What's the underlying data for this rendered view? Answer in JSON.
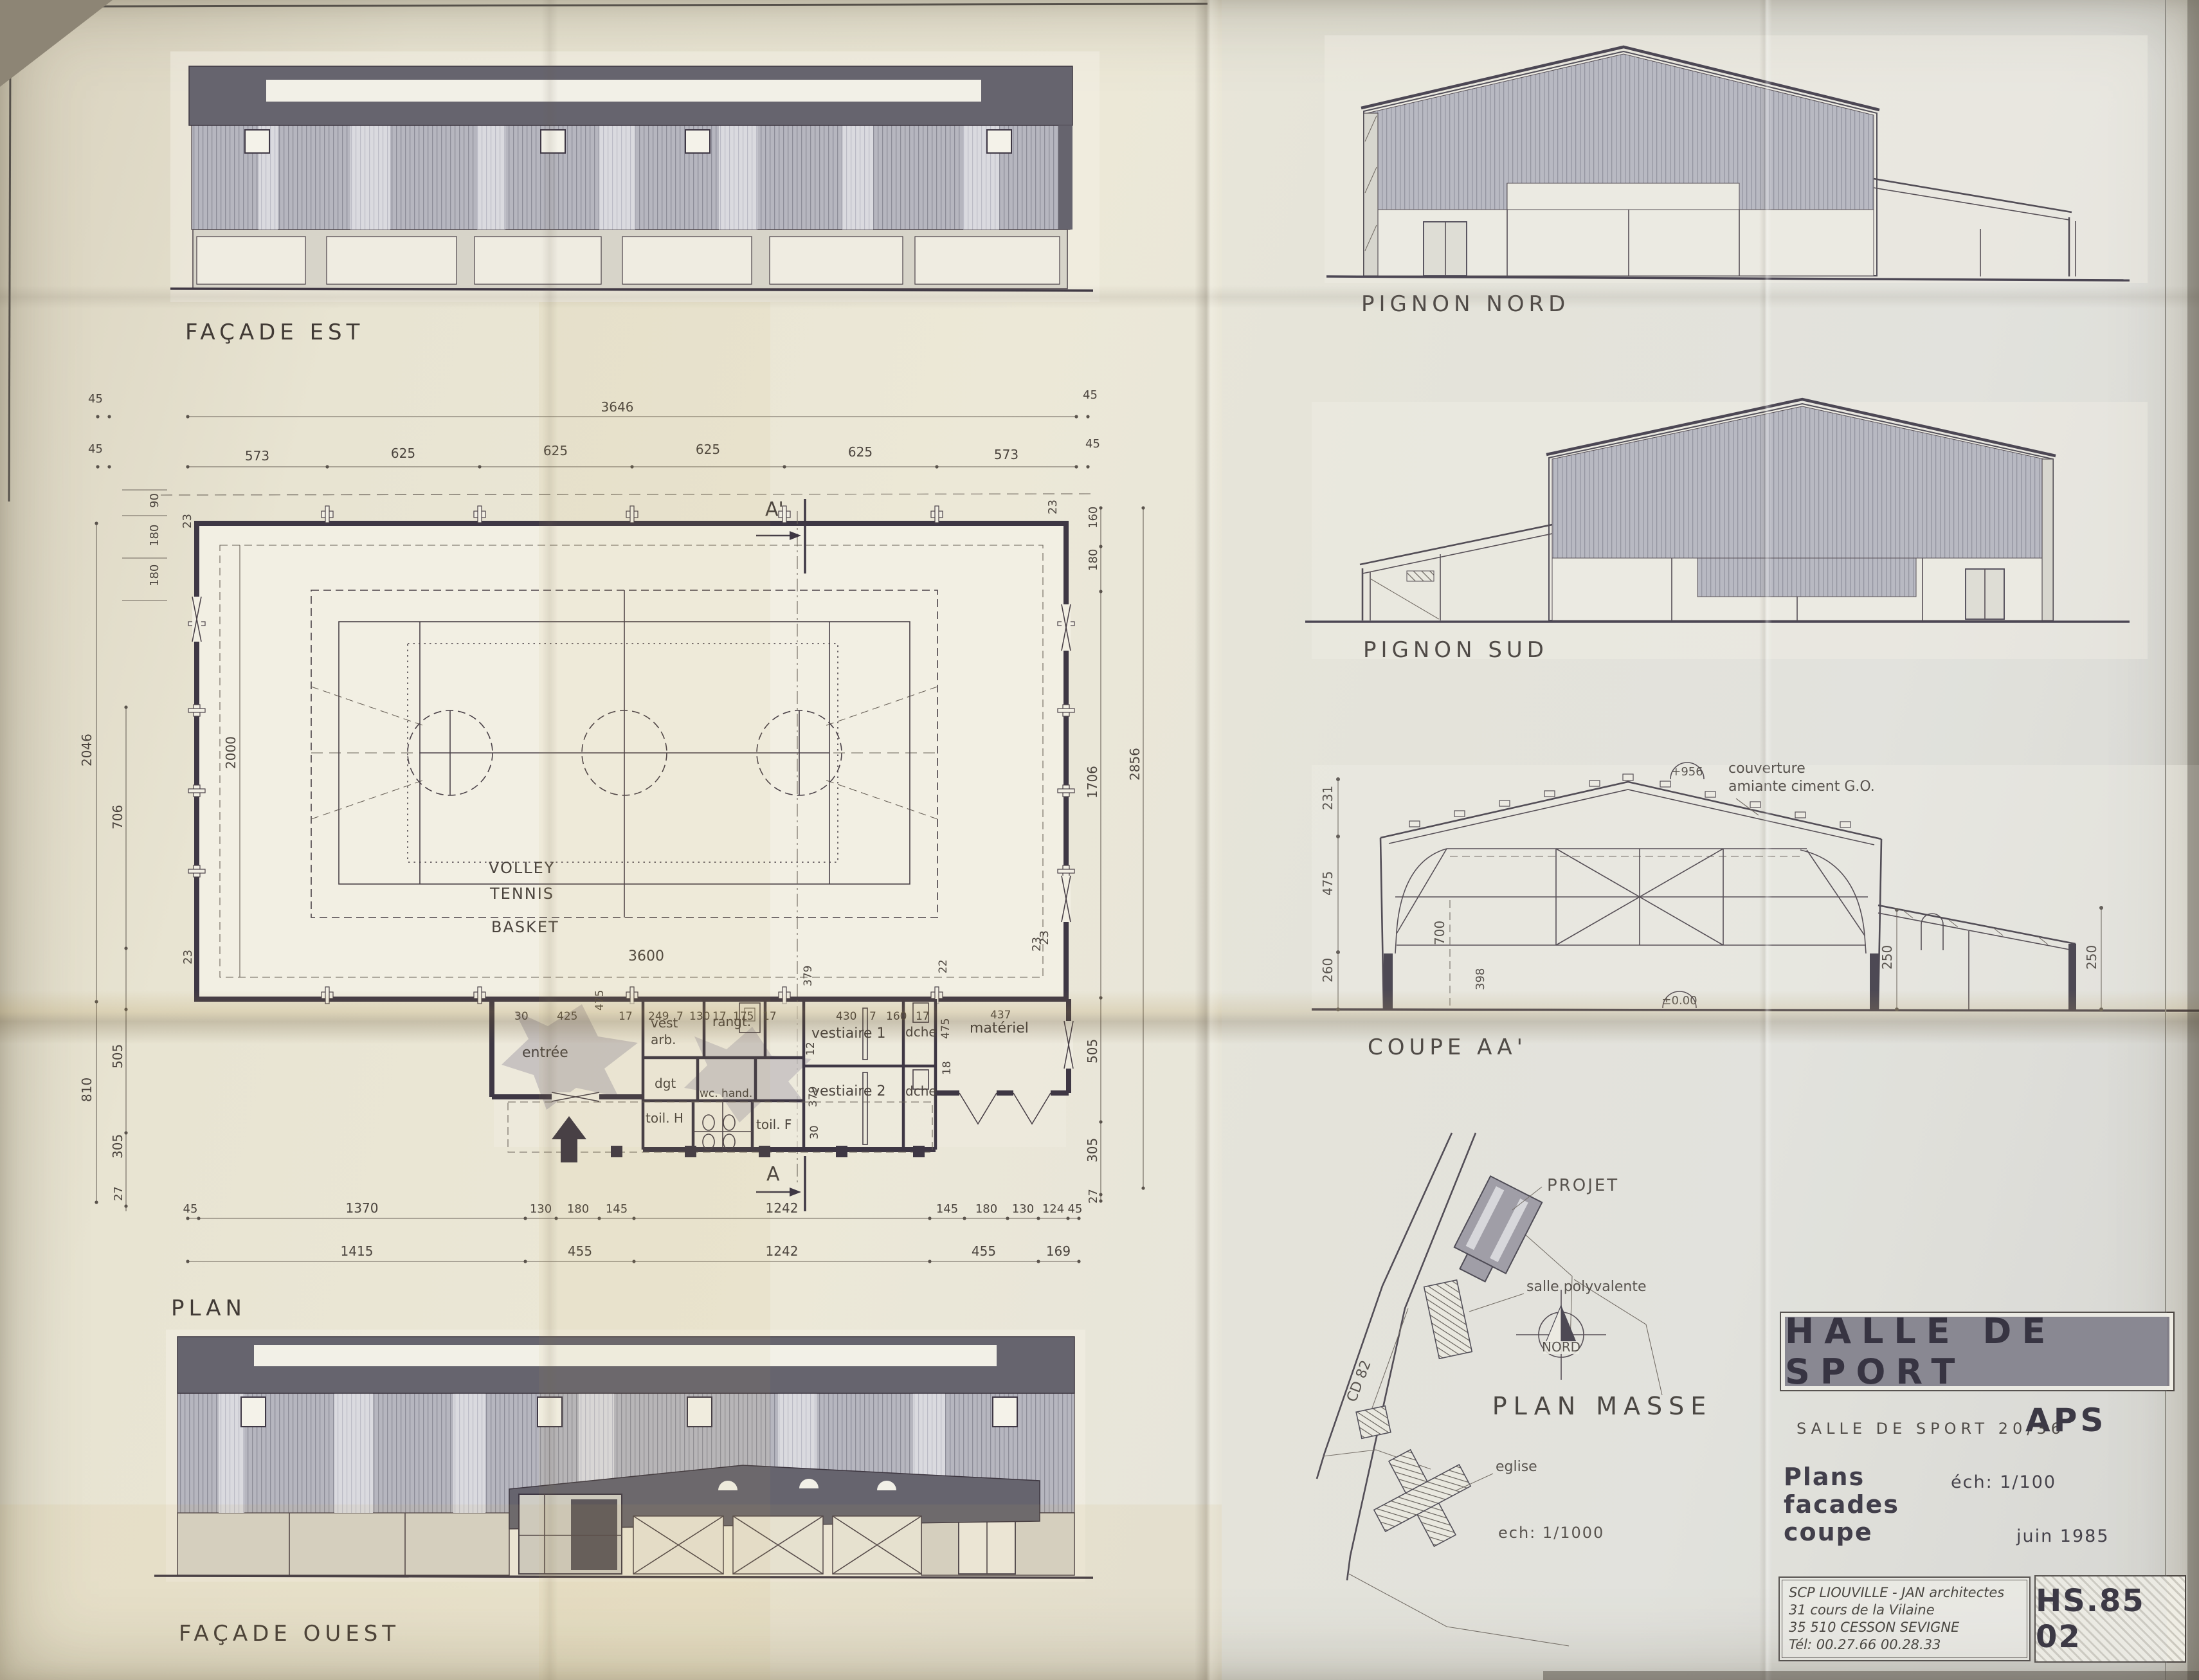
{
  "facade_est": {
    "label": "FAÇADE EST"
  },
  "facade_ouest": {
    "label": "FAÇADE OUEST"
  },
  "pignon_nord": {
    "label": "PIGNON NORD"
  },
  "pignon_sud": {
    "label": "PIGNON SUD"
  },
  "coupe": {
    "label": "COUPE AA'",
    "ridge_level": "+956",
    "note_line1": "couverture",
    "note_line2": "amiante ciment G.O.",
    "left_dims": [
      "231",
      "475",
      "260"
    ],
    "inner_dims": [
      "700",
      "398"
    ],
    "annex_dims": [
      "250",
      "250"
    ],
    "ground_level": "±0.00"
  },
  "plan": {
    "label": "PLAN",
    "top_total": "3646",
    "bays": [
      "573",
      "625",
      "625",
      "625",
      "625",
      "573"
    ],
    "edge45": [
      "45",
      "45",
      "45",
      "45"
    ],
    "corner23": [
      "23",
      "23",
      "23",
      "23"
    ],
    "west_chain": [
      "90",
      "180",
      "180"
    ],
    "west_outer": [
      "2046",
      "706",
      "2000",
      "810",
      "505",
      "305",
      "27"
    ],
    "east_chain": [
      "160",
      "180",
      "1706",
      "505",
      "305",
      "27"
    ],
    "east_total": "2856",
    "east_corner": "23",
    "court": {
      "volley": "VOLLEY",
      "tennis": "TENNIS",
      "basket": "BASKET",
      "width_dim": "3600",
      "depth_dim": "2000"
    },
    "annex_top": [
      "30",
      "425",
      "475",
      "17",
      "249",
      "7",
      "130",
      "17",
      "175",
      "17",
      "430",
      "7",
      "160",
      "17",
      "437"
    ],
    "annex_side": [
      "379",
      "12",
      "379",
      "30",
      "22",
      "475",
      "18"
    ],
    "rooms": {
      "entree": "entrée",
      "vest_l1": "vest",
      "vest_l2": "arb.",
      "rangt": "rangt.",
      "dgt": "dgt",
      "wc_hand": "wc. hand.",
      "toil_h": "toil. H",
      "toil_f": "toil. F",
      "vestiaire1": "vestiaire 1",
      "dche1": "dche",
      "vestiaire2": "vestiaire 2",
      "dche2": "dche",
      "materiel": "matériel"
    },
    "bottom1": [
      "45",
      "1370",
      "130",
      "180",
      "145",
      "1242",
      "145",
      "180",
      "130",
      "124",
      "45"
    ],
    "bottom2": [
      "1415",
      "455",
      "1242",
      "455",
      "169"
    ],
    "sections": {
      "a": "A",
      "a_prime": "A'"
    }
  },
  "plan_masse": {
    "label": "PLAN MASSE",
    "projet": "PROJET",
    "salle": "salle polyvalente",
    "eglise": "eglise",
    "road": "CD 82",
    "north": "NORD",
    "scale": "ech: 1/1000"
  },
  "title_block": {
    "title": "HALLE DE SPORT",
    "subtitle": "SALLE DE SPORT 20/36",
    "phase": "APS",
    "doc1": "Plans",
    "doc2": "facades",
    "doc3": "coupe",
    "scale": "éch: 1/100",
    "date": "juin 1985",
    "firm": "SCP LIOUVILLE - JAN architectes",
    "address1": "31 cours de la Vilaine",
    "address2": "35 510 CESSON SEVIGNE",
    "phone": "Tél: 00.27.66   00.28.33",
    "ref": "HS.85 02"
  }
}
